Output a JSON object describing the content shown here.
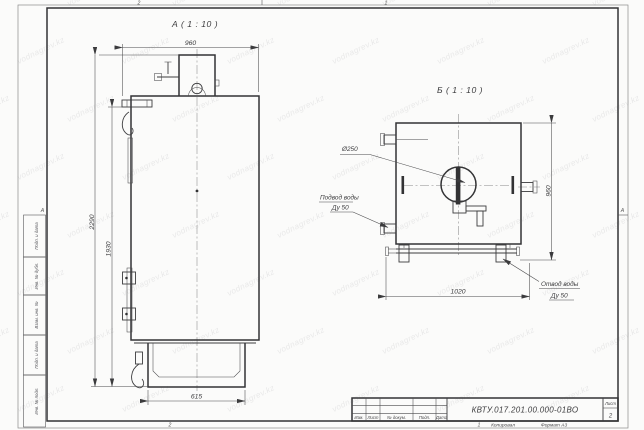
{
  "watermark": {
    "text": "vodnagrev.kz"
  },
  "frame": {
    "zones": {
      "top_left": "2",
      "top_right": "1",
      "bottom_left": "2",
      "bottom_right": "1",
      "row_left": "А",
      "row_right": "А"
    },
    "margin_cells": [
      {
        "label": "Подп. и дата"
      },
      {
        "label": "Инв. № дубл."
      },
      {
        "label": "Взам. инв. №"
      },
      {
        "label": "Подп. и дата"
      },
      {
        "label": "Инв. № подл."
      }
    ]
  },
  "view_a": {
    "label": "А ( 1 : 10 )",
    "dim_width_top": "960",
    "dim_height_overall": "2290",
    "dim_height_body": "1930",
    "dim_base_width": "615"
  },
  "view_b": {
    "label": "Б ( 1 : 10 )",
    "dim_hole": "Ø250",
    "dim_height": "960",
    "dim_width": "1020",
    "leader_inlet_line1": "Подвод воды",
    "leader_inlet_line2": "Ду 50",
    "leader_outlet_line1": "Отвод воды",
    "leader_outlet_line2": "Ду 50"
  },
  "title_block": {
    "doc_number": "КВТУ.017.201.00.000-01ВО",
    "columns": [
      "Изм.",
      "Лист",
      "№ докум.",
      "Подп.",
      "Дата"
    ],
    "sheet_label": "Лист",
    "sheet_number": "2",
    "footer_zone": "1",
    "footer_copied": "Копировал",
    "footer_format": "Формат А3"
  }
}
